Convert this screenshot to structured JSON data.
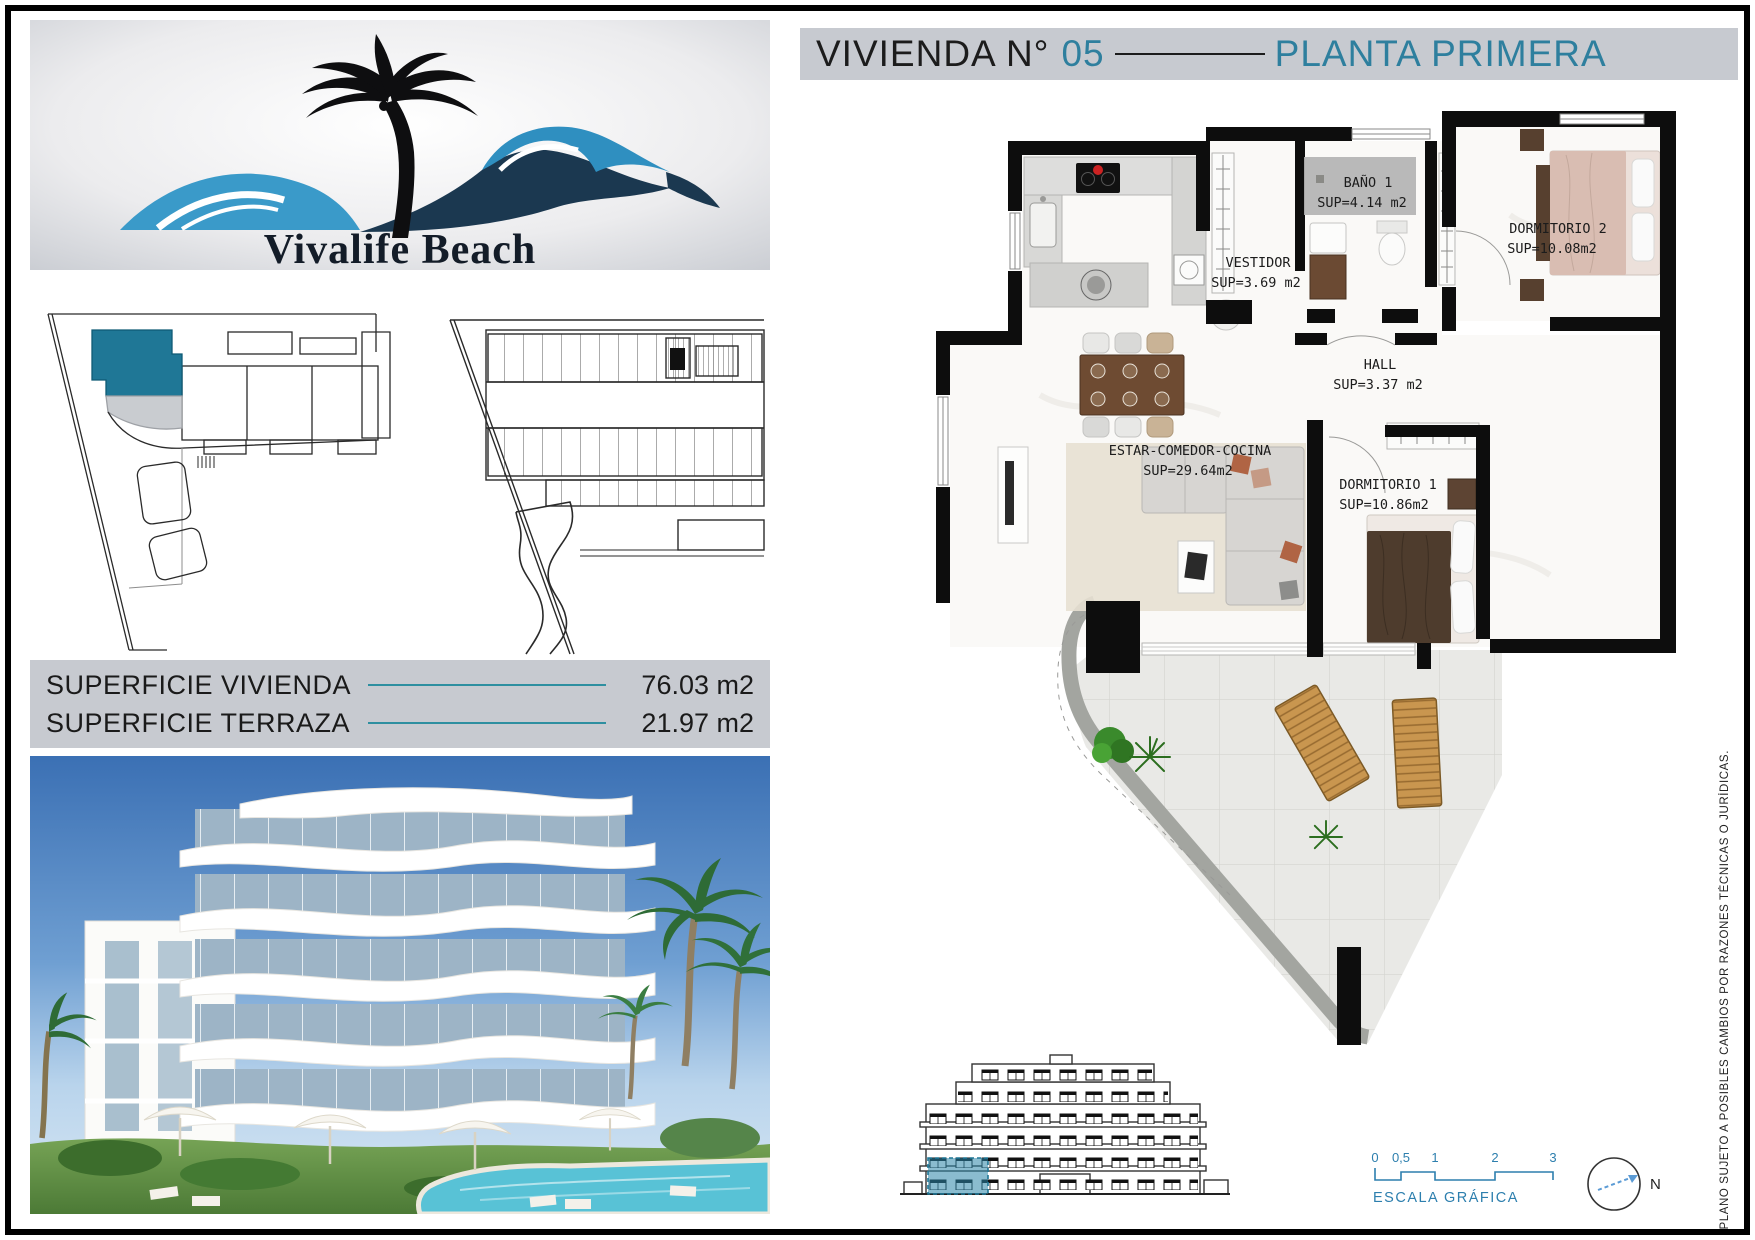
{
  "header": {
    "title_black": "VIVIENDA N°",
    "unit_number": "05",
    "title_teal": "PLANTA PRIMERA"
  },
  "logo": {
    "brand": "Vivalife Beach"
  },
  "surfaces": {
    "rows": [
      {
        "label": "SUPERFICIE VIVIENDA",
        "value": "76.03 m2"
      },
      {
        "label": "SUPERFICIE TERRAZA",
        "value": "21.97 m2"
      }
    ]
  },
  "plan": {
    "rooms": [
      {
        "name": "BAÑO 1",
        "sup": "SUP=4.14 m2"
      },
      {
        "name": "VESTIDOR",
        "sup": "SUP=3.69 m2"
      },
      {
        "name": "DORMITORIO 2",
        "sup": "SUP=10.08m2"
      },
      {
        "name": "HALL",
        "sup": "SUP=3.37 m2"
      },
      {
        "name": "ESTAR-COMEDOR-COCINA",
        "sup": "SUP=29.64m2"
      },
      {
        "name": "DORMITORIO 1",
        "sup": "SUP=10.86m2"
      }
    ]
  },
  "scale_bar": {
    "ticks": [
      "0",
      "0,5",
      "1",
      "2",
      "3"
    ],
    "label": "ESCALA GRÁFICA"
  },
  "compass": {
    "label": "N"
  },
  "disclaimer": "PLANO SUJETO A POSIBLES CAMBIOS POR RAZONES TÉCNICAS O JURÍDICAS.",
  "colors": {
    "accent_teal": "#2e7f9e",
    "bar_gray": "#c7cad0",
    "scale_blue": "#2d7fae",
    "highlight_teal": "#1f7796",
    "surface_line_teal": "#2e8fa0"
  }
}
